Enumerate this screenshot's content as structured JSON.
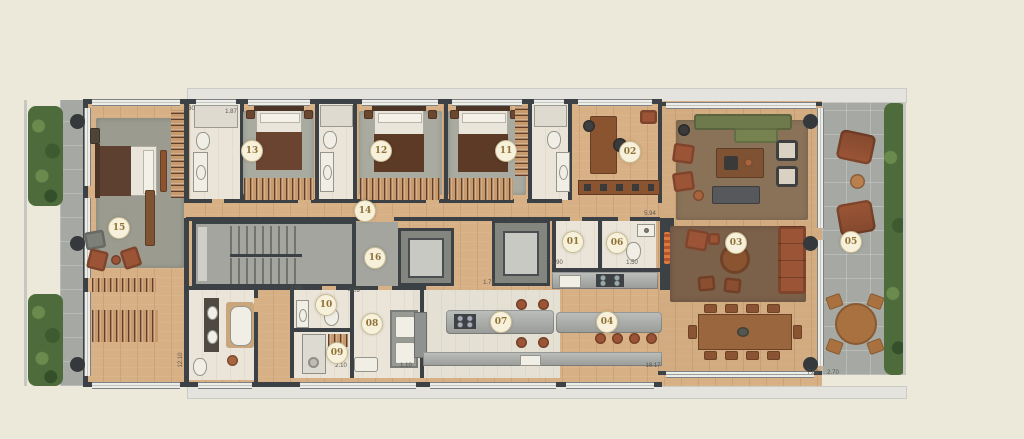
{
  "plan": {
    "title": "apartment floor plan",
    "markers": [
      {
        "id": "01",
        "x": 573,
        "y": 242
      },
      {
        "id": "02",
        "x": 630,
        "y": 152
      },
      {
        "id": "03",
        "x": 736,
        "y": 243
      },
      {
        "id": "04",
        "x": 607,
        "y": 322
      },
      {
        "id": "05",
        "x": 851,
        "y": 242
      },
      {
        "id": "06",
        "x": 617,
        "y": 243
      },
      {
        "id": "07",
        "x": 501,
        "y": 322
      },
      {
        "id": "08",
        "x": 372,
        "y": 324
      },
      {
        "id": "09",
        "x": 337,
        "y": 353
      },
      {
        "id": "10",
        "x": 326,
        "y": 305
      },
      {
        "id": "11",
        "x": 506,
        "y": 151
      },
      {
        "id": "12",
        "x": 381,
        "y": 151
      },
      {
        "id": "13",
        "x": 252,
        "y": 151
      },
      {
        "id": "14",
        "x": 365,
        "y": 211
      },
      {
        "id": "15",
        "x": 119,
        "y": 228
      },
      {
        "id": "16",
        "x": 375,
        "y": 258
      }
    ],
    "dimensions": [
      {
        "text": "1.30",
        "x": 189,
        "y": 109,
        "vertical": false
      },
      {
        "text": "1.87",
        "x": 231,
        "y": 112,
        "vertical": false
      },
      {
        "text": "2.90",
        "x": 296,
        "y": 289,
        "vertical": false
      },
      {
        "text": "4.09",
        "x": 354,
        "y": 291,
        "vertical": false
      },
      {
        "text": "1.75",
        "x": 489,
        "y": 283,
        "vertical": false
      },
      {
        "text": "1.90",
        "x": 557,
        "y": 263,
        "vertical": false
      },
      {
        "text": "1.50",
        "x": 632,
        "y": 263,
        "vertical": false
      },
      {
        "text": "5.94",
        "x": 650,
        "y": 214,
        "vertical": false
      },
      {
        "text": "2.10",
        "x": 341,
        "y": 366,
        "vertical": false
      },
      {
        "text": "1.10",
        "x": 406,
        "y": 366,
        "vertical": false
      },
      {
        "text": "18.17",
        "x": 653,
        "y": 366,
        "vertical": false
      },
      {
        "text": "12.10",
        "x": 181,
        "y": 360,
        "vertical": true
      },
      {
        "text": "7.80",
        "x": 813,
        "y": 373,
        "vertical": false
      },
      {
        "text": "2.70",
        "x": 833,
        "y": 373,
        "vertical": false
      }
    ],
    "palette": {
      "background": "#EDE9DA",
      "wall": "#3C4145",
      "wood": "#D8B085",
      "tile": "#EAE5D8",
      "gray_floor": "#A3A59E",
      "paver": "#A5A8A3",
      "hedge": "#4E6C3B",
      "rug_bedroom": "#A9ABA0",
      "rug_master": "#9B9C8F",
      "rug_living": "#8A7258",
      "rug_living2": "#7B604A",
      "leather": "#9B5536",
      "sofa_green": "#6E7A4B",
      "counter": "#A9ABA8",
      "fixture": "#F0EEE5",
      "marker_bg": "#F7F0DA",
      "marker_border": "#C9BC94",
      "marker_text": "#8F7336",
      "dim_text": "#56564F",
      "overhang": "#E4E3DD",
      "flame": "#D97B3F"
    }
  }
}
